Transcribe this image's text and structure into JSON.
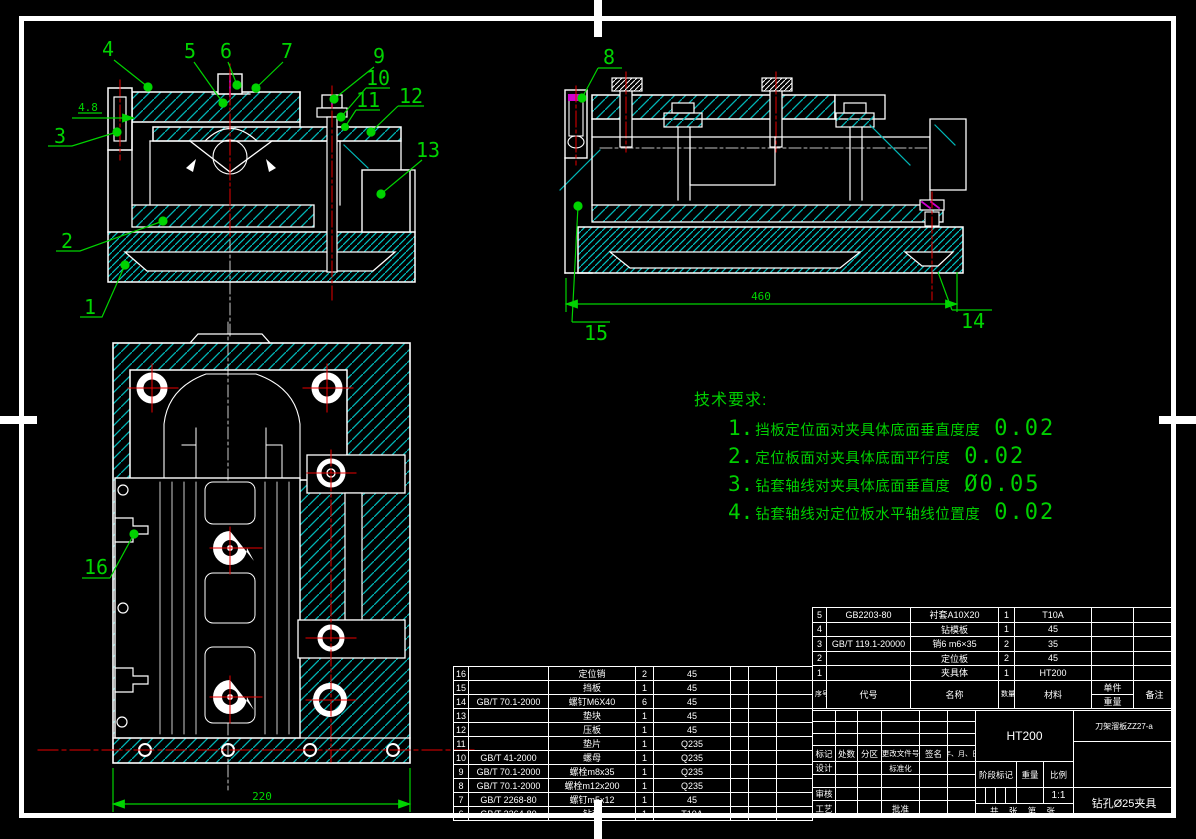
{
  "colors": {
    "background": "#000000",
    "line": "#ffffff",
    "hatch": "#00b6b6",
    "annotation": "#00d400",
    "centerline": "#e80000",
    "detail_magenta": "#cf00cf"
  },
  "tech_requirements": {
    "title": "技术要求:",
    "items": [
      {
        "num": "1.",
        "text": "挡板定位面对夹具体底面垂直度度",
        "value": "0.02"
      },
      {
        "num": "2.",
        "text": "定位板面对夹具体底面平行度",
        "value": "0.02"
      },
      {
        "num": "3.",
        "text": "钻套轴线对夹具体底面垂直度",
        "value": "Ø0.05"
      },
      {
        "num": "4.",
        "text": "钻套轴线对定位板水平轴线位置度",
        "value": "0.02"
      }
    ]
  },
  "views": {
    "front": {
      "dim": "4.8",
      "callouts": [
        "4",
        "5",
        "6",
        "7",
        "9",
        "10",
        "11",
        "12",
        "13",
        "3",
        "2",
        "1"
      ]
    },
    "side": {
      "dim": "460",
      "callouts": [
        "8",
        "15",
        "14"
      ]
    },
    "plan": {
      "dim": "220",
      "callouts": [
        "16"
      ]
    }
  },
  "parts_list_left": {
    "rows": [
      [
        "16",
        "",
        "定位销",
        "2",
        "45",
        "",
        "",
        ""
      ],
      [
        "15",
        "",
        "挡板",
        "1",
        "45",
        "",
        "",
        ""
      ],
      [
        "14",
        "GB/T 70.1-2000",
        "螺钉M6X40",
        "6",
        "45",
        "",
        "",
        ""
      ],
      [
        "13",
        "",
        "垫块",
        "1",
        "45",
        "",
        "",
        ""
      ],
      [
        "12",
        "",
        "压板",
        "1",
        "45",
        "",
        "",
        ""
      ],
      [
        "11",
        "",
        "垫片",
        "1",
        "Q235",
        "",
        "",
        ""
      ],
      [
        "10",
        "GB/T 41-2000",
        "螺母",
        "1",
        "Q235",
        "",
        "",
        ""
      ],
      [
        "9",
        "GB/T 70.1-2000",
        "螺栓m8x35",
        "1",
        "Q235",
        "",
        "",
        ""
      ],
      [
        "8",
        "GB/T 70.1-2000",
        "螺栓m12x200",
        "1",
        "Q235",
        "",
        "",
        ""
      ],
      [
        "7",
        "GB/T 2268-80",
        "螺钉m5x12",
        "1",
        "45",
        "",
        "",
        ""
      ],
      [
        "6",
        "GB/T 2264-80",
        "钻套",
        "1",
        "T10A",
        "",
        "",
        ""
      ]
    ]
  },
  "parts_list_right": {
    "header": {
      "no": "序号",
      "code": "代号",
      "name": "名称",
      "qty": "数量",
      "material": "材料",
      "unit": "单件",
      "weight": "重量",
      "remarks": "备注"
    },
    "rows": [
      [
        "5",
        "GB2203-80",
        "衬套A10X20",
        "1",
        "T10A",
        "",
        "",
        ""
      ],
      [
        "4",
        "",
        "钻模板",
        "1",
        "45",
        "",
        "",
        ""
      ],
      [
        "3",
        "GB/T 119.1-20000",
        "销6 m6×35",
        "2",
        "35",
        "",
        "",
        ""
      ],
      [
        "2",
        "",
        "定位板",
        "2",
        "45",
        "",
        "",
        ""
      ],
      [
        "1",
        "",
        "夹具体",
        "1",
        "HT200",
        "",
        "",
        ""
      ]
    ]
  },
  "title_block": {
    "material": "HT200",
    "drawing_code": "刀架溜板ZZ27-a",
    "drawing_title": "钻孔Ø25夹具",
    "scale": "1:1",
    "labels": {
      "mark": "标记",
      "count": "处数",
      "zone": "分区",
      "change_doc": "更改文件号",
      "sign": "签名",
      "date": "年、月、日",
      "design": "设计",
      "standardization": "标准化",
      "review": "审核",
      "process": "工艺",
      "approve": "批准",
      "stage_mark": "阶段标记",
      "weight": "重量",
      "scale_label": "比例",
      "sheet": "共  张  第  张"
    }
  }
}
